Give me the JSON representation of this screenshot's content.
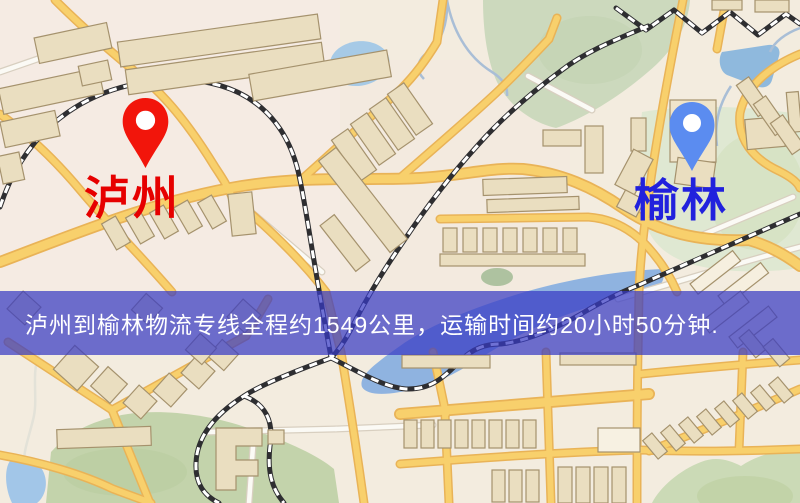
{
  "page": {
    "type": "logistics-route-map"
  },
  "banner": {
    "text": "泸州到榆林物流专线全程约1549公里，运输时间约20小时50分钟.",
    "bg_color": "#3a3cc4",
    "text_color": "#ffffff"
  },
  "route": {
    "origin": "泸州",
    "destination": "榆林",
    "distance": "约1549公里",
    "duration": "约20小时50分钟"
  },
  "markers": {
    "origin": {
      "label": "泸州",
      "pin_color": "#f2150b",
      "label_color": "#e60000"
    },
    "destination": {
      "label": "榆林",
      "pin_color": "#5b8cf0",
      "label_color": "#2121dd"
    }
  },
  "map": {
    "palette": {
      "background": "#f3ecdf",
      "road_fill": "#f8d06c",
      "road_casing": "#e9b357",
      "minor_road": "#fbfaf5",
      "railway": "#2e2e31",
      "water": "#8fb3e0",
      "park": "#c9d8b6",
      "building": "#eadec0"
    }
  }
}
